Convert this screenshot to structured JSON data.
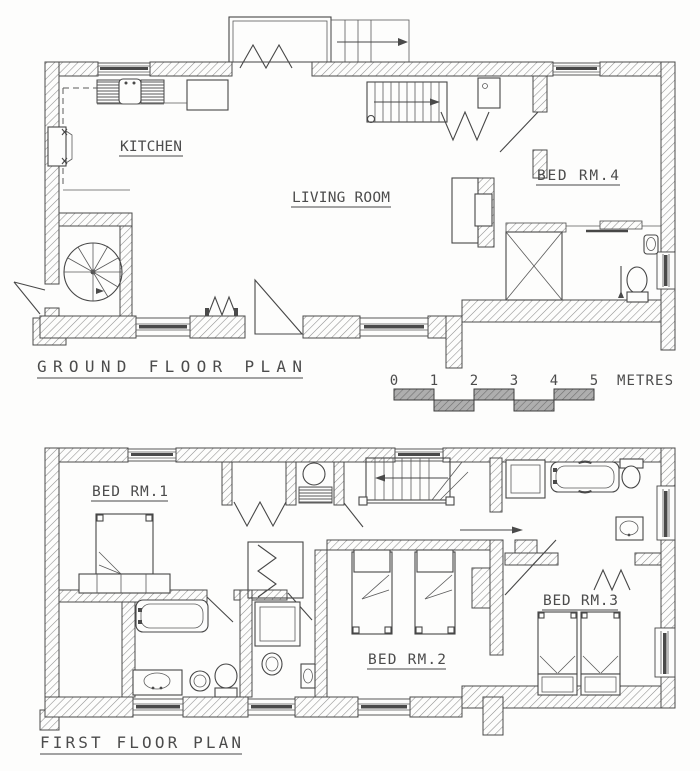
{
  "drawing": {
    "type": "two-storey house floor plan",
    "background_color": "#fdfdfc",
    "line_color": "#4a4a4a"
  },
  "ground_floor": {
    "title": "GROUND FLOOR PLAN",
    "rooms": {
      "kitchen": "KITCHEN",
      "living_room": "LIVING ROOM",
      "bed_rm_4": "BED RM.4"
    }
  },
  "first_floor": {
    "title": "FIRST FLOOR PLAN",
    "rooms": {
      "bed_rm_1": "BED RM.1",
      "bed_rm_2": "BED RM.2",
      "bed_rm_3": "BED RM.3"
    }
  },
  "scale_bar": {
    "ticks": [
      "0",
      "1",
      "2",
      "3",
      "4",
      "5"
    ],
    "unit_label": "METRES"
  }
}
